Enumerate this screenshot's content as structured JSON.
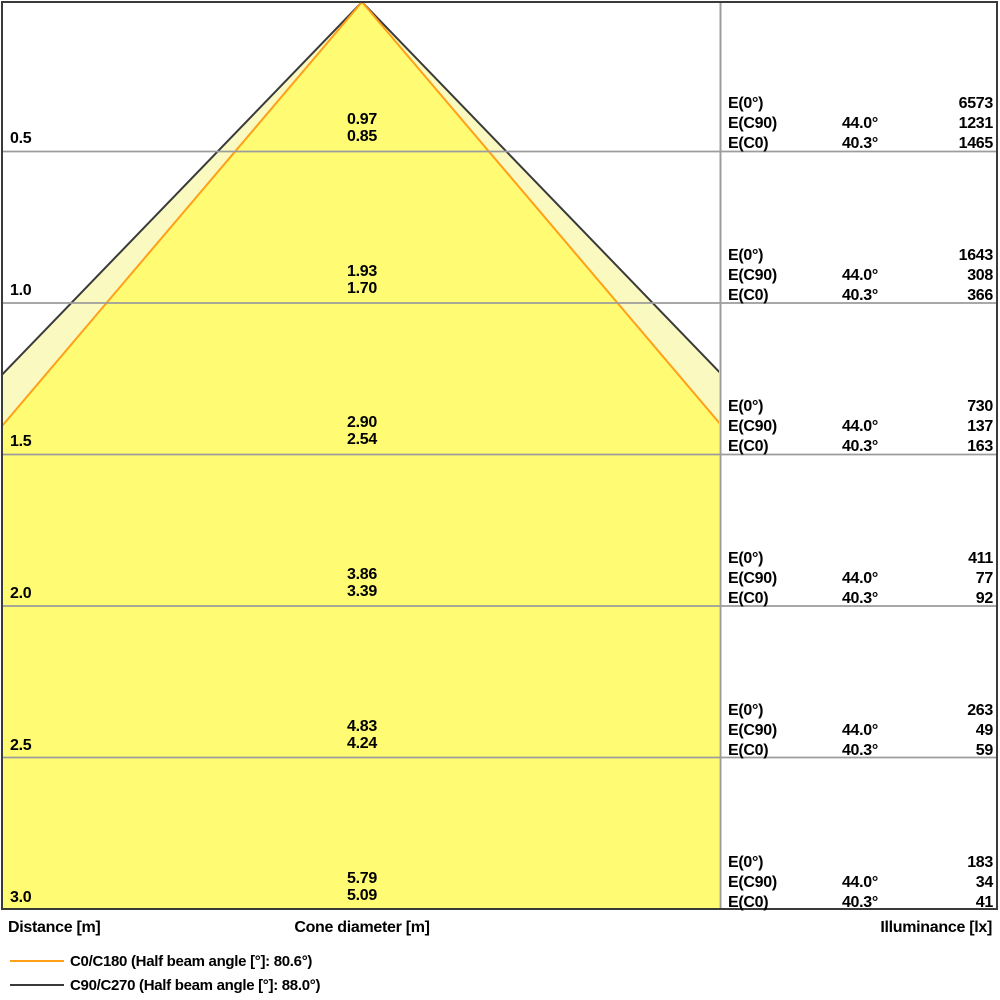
{
  "colors": {
    "cone_inner_fill": "#FFFB73",
    "cone_outer_fill": "#FAFAC0",
    "c0_line": "#FFA018",
    "c90_line": "#3A3A3A",
    "gridline": "#9C9C9C",
    "border": "#3A3A3A",
    "text": "#000000"
  },
  "axis": {
    "distance": "Distance [m]",
    "cone": "Cone diameter [m]",
    "illuminance": "Illuminance [lx]"
  },
  "labels": {
    "e0": "E(0°)",
    "ec90": "E(C90)",
    "ec0": "E(C0)"
  },
  "legend": [
    {
      "label": "C0/C180 (Half beam angle [°]: 80.6°)",
      "color": "#FFA018"
    },
    {
      "label": "C90/C270 (Half beam angle [°]: 88.0°)",
      "color": "#3A3A3A"
    }
  ],
  "rows": [
    {
      "distance": "0.5",
      "cone_c90": "0.97",
      "cone_c0": "0.85",
      "e0": "6573",
      "ec90_angle": "44.0°",
      "ec90": "1231",
      "ec0_angle": "40.3°",
      "ec0": "1465"
    },
    {
      "distance": "1.0",
      "cone_c90": "1.93",
      "cone_c0": "1.70",
      "e0": "1643",
      "ec90_angle": "44.0°",
      "ec90": "308",
      "ec0_angle": "40.3°",
      "ec0": "366"
    },
    {
      "distance": "1.5",
      "cone_c90": "2.90",
      "cone_c0": "2.54",
      "e0": "730",
      "ec90_angle": "44.0°",
      "ec90": "137",
      "ec0_angle": "40.3°",
      "ec0": "163"
    },
    {
      "distance": "2.0",
      "cone_c90": "3.86",
      "cone_c0": "3.39",
      "e0": "411",
      "ec90_angle": "44.0°",
      "ec90": "77",
      "ec0_angle": "40.3°",
      "ec0": "92"
    },
    {
      "distance": "2.5",
      "cone_c90": "4.83",
      "cone_c0": "4.24",
      "e0": "263",
      "ec90_angle": "44.0°",
      "ec90": "49",
      "ec0_angle": "40.3°",
      "ec0": "59"
    },
    {
      "distance": "3.0",
      "cone_c90": "5.79",
      "cone_c0": "5.09",
      "e0": "183",
      "ec90_angle": "44.0°",
      "ec90": "34",
      "ec0_angle": "40.3°",
      "ec0": "41"
    }
  ],
  "chart_data": {
    "type": "area",
    "title": "Luminous cone diagram",
    "xlabel": "Cone diameter [m]",
    "ylabel": "Distance [m]",
    "ylim": [
      0,
      3.0
    ],
    "grid": true,
    "legend_position": "bottom-left",
    "distances_m": [
      0.5,
      1.0,
      1.5,
      2.0,
      2.5,
      3.0
    ],
    "series": [
      {
        "name": "C0/C180 (Half beam angle [°]: 80.6°)",
        "half_beam_angle_deg": 80.6,
        "e_half_angle_deg": 40.3,
        "color": "#FFA018",
        "cone_diameter_m": [
          0.85,
          1.7,
          2.54,
          3.39,
          4.24,
          5.09
        ],
        "illuminance_lx": [
          1465,
          366,
          163,
          92,
          59,
          41
        ]
      },
      {
        "name": "C90/C270 (Half beam angle [°]: 88.0°)",
        "half_beam_angle_deg": 88.0,
        "e_half_angle_deg": 44.0,
        "color": "#3A3A3A",
        "cone_diameter_m": [
          0.97,
          1.93,
          2.9,
          3.86,
          4.83,
          5.79
        ],
        "illuminance_lx": [
          1231,
          308,
          137,
          77,
          49,
          34
        ]
      }
    ],
    "e0_illuminance_lx": [
      6573,
      1643,
      730,
      411,
      263,
      183
    ]
  }
}
